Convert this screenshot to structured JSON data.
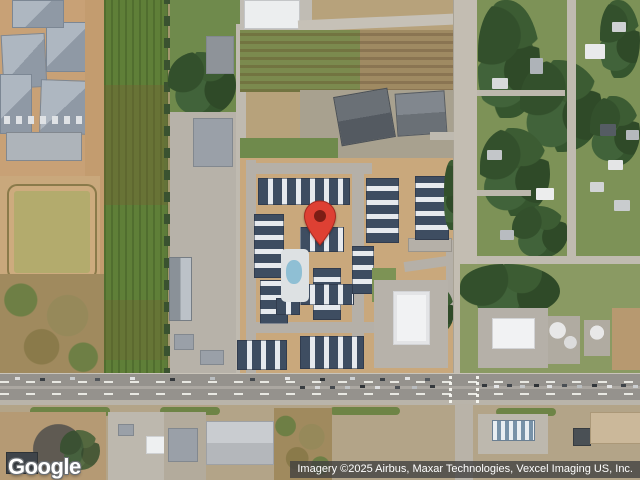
{
  "branding": {
    "logo": "Google"
  },
  "attribution": {
    "text": "Imagery ©2025 Airbus, Maxar Technologies, Vexcel Imaging US, Inc."
  },
  "map": {
    "type": "satellite-imagery",
    "marker": {
      "name": "red-location-pin",
      "color": "#DE4033",
      "outline": "#A8291F",
      "inner_color": "#7C1D15"
    },
    "features": {
      "areas": [
        "construction-site",
        "retention-pond",
        "crop-field-strip",
        "farm-plots",
        "apartment-complex",
        "swimming-pool",
        "residential-neighborhood",
        "commercial-white-building",
        "tank-yard",
        "warehouse",
        "gas-station-canopy",
        "scrub-lot"
      ],
      "roads": [
        "east-west-highway",
        "north-south-arterial",
        "farm-access-road",
        "top-cross-road",
        "residential-street",
        "complex-loop-road"
      ],
      "traffic": "cars-on-highway"
    }
  },
  "palette": {
    "pin_red": "#DE4033",
    "pin_core": "#7C1D15",
    "dirt_tan": "#c9a87c",
    "field_green": "#5f7f38",
    "grass_green": "#7d9257",
    "tree_green": "#33502c",
    "road_gray": "#bfbab0",
    "highway_gray": "#95928d",
    "apartment_roof": "#3e4d61",
    "roof_white": "#e7eaee",
    "pond_khaki": "#b3ab6d",
    "attribution_bg": "#404040",
    "attribution_text": "#ffffff",
    "logo_text": "#ffffff"
  }
}
